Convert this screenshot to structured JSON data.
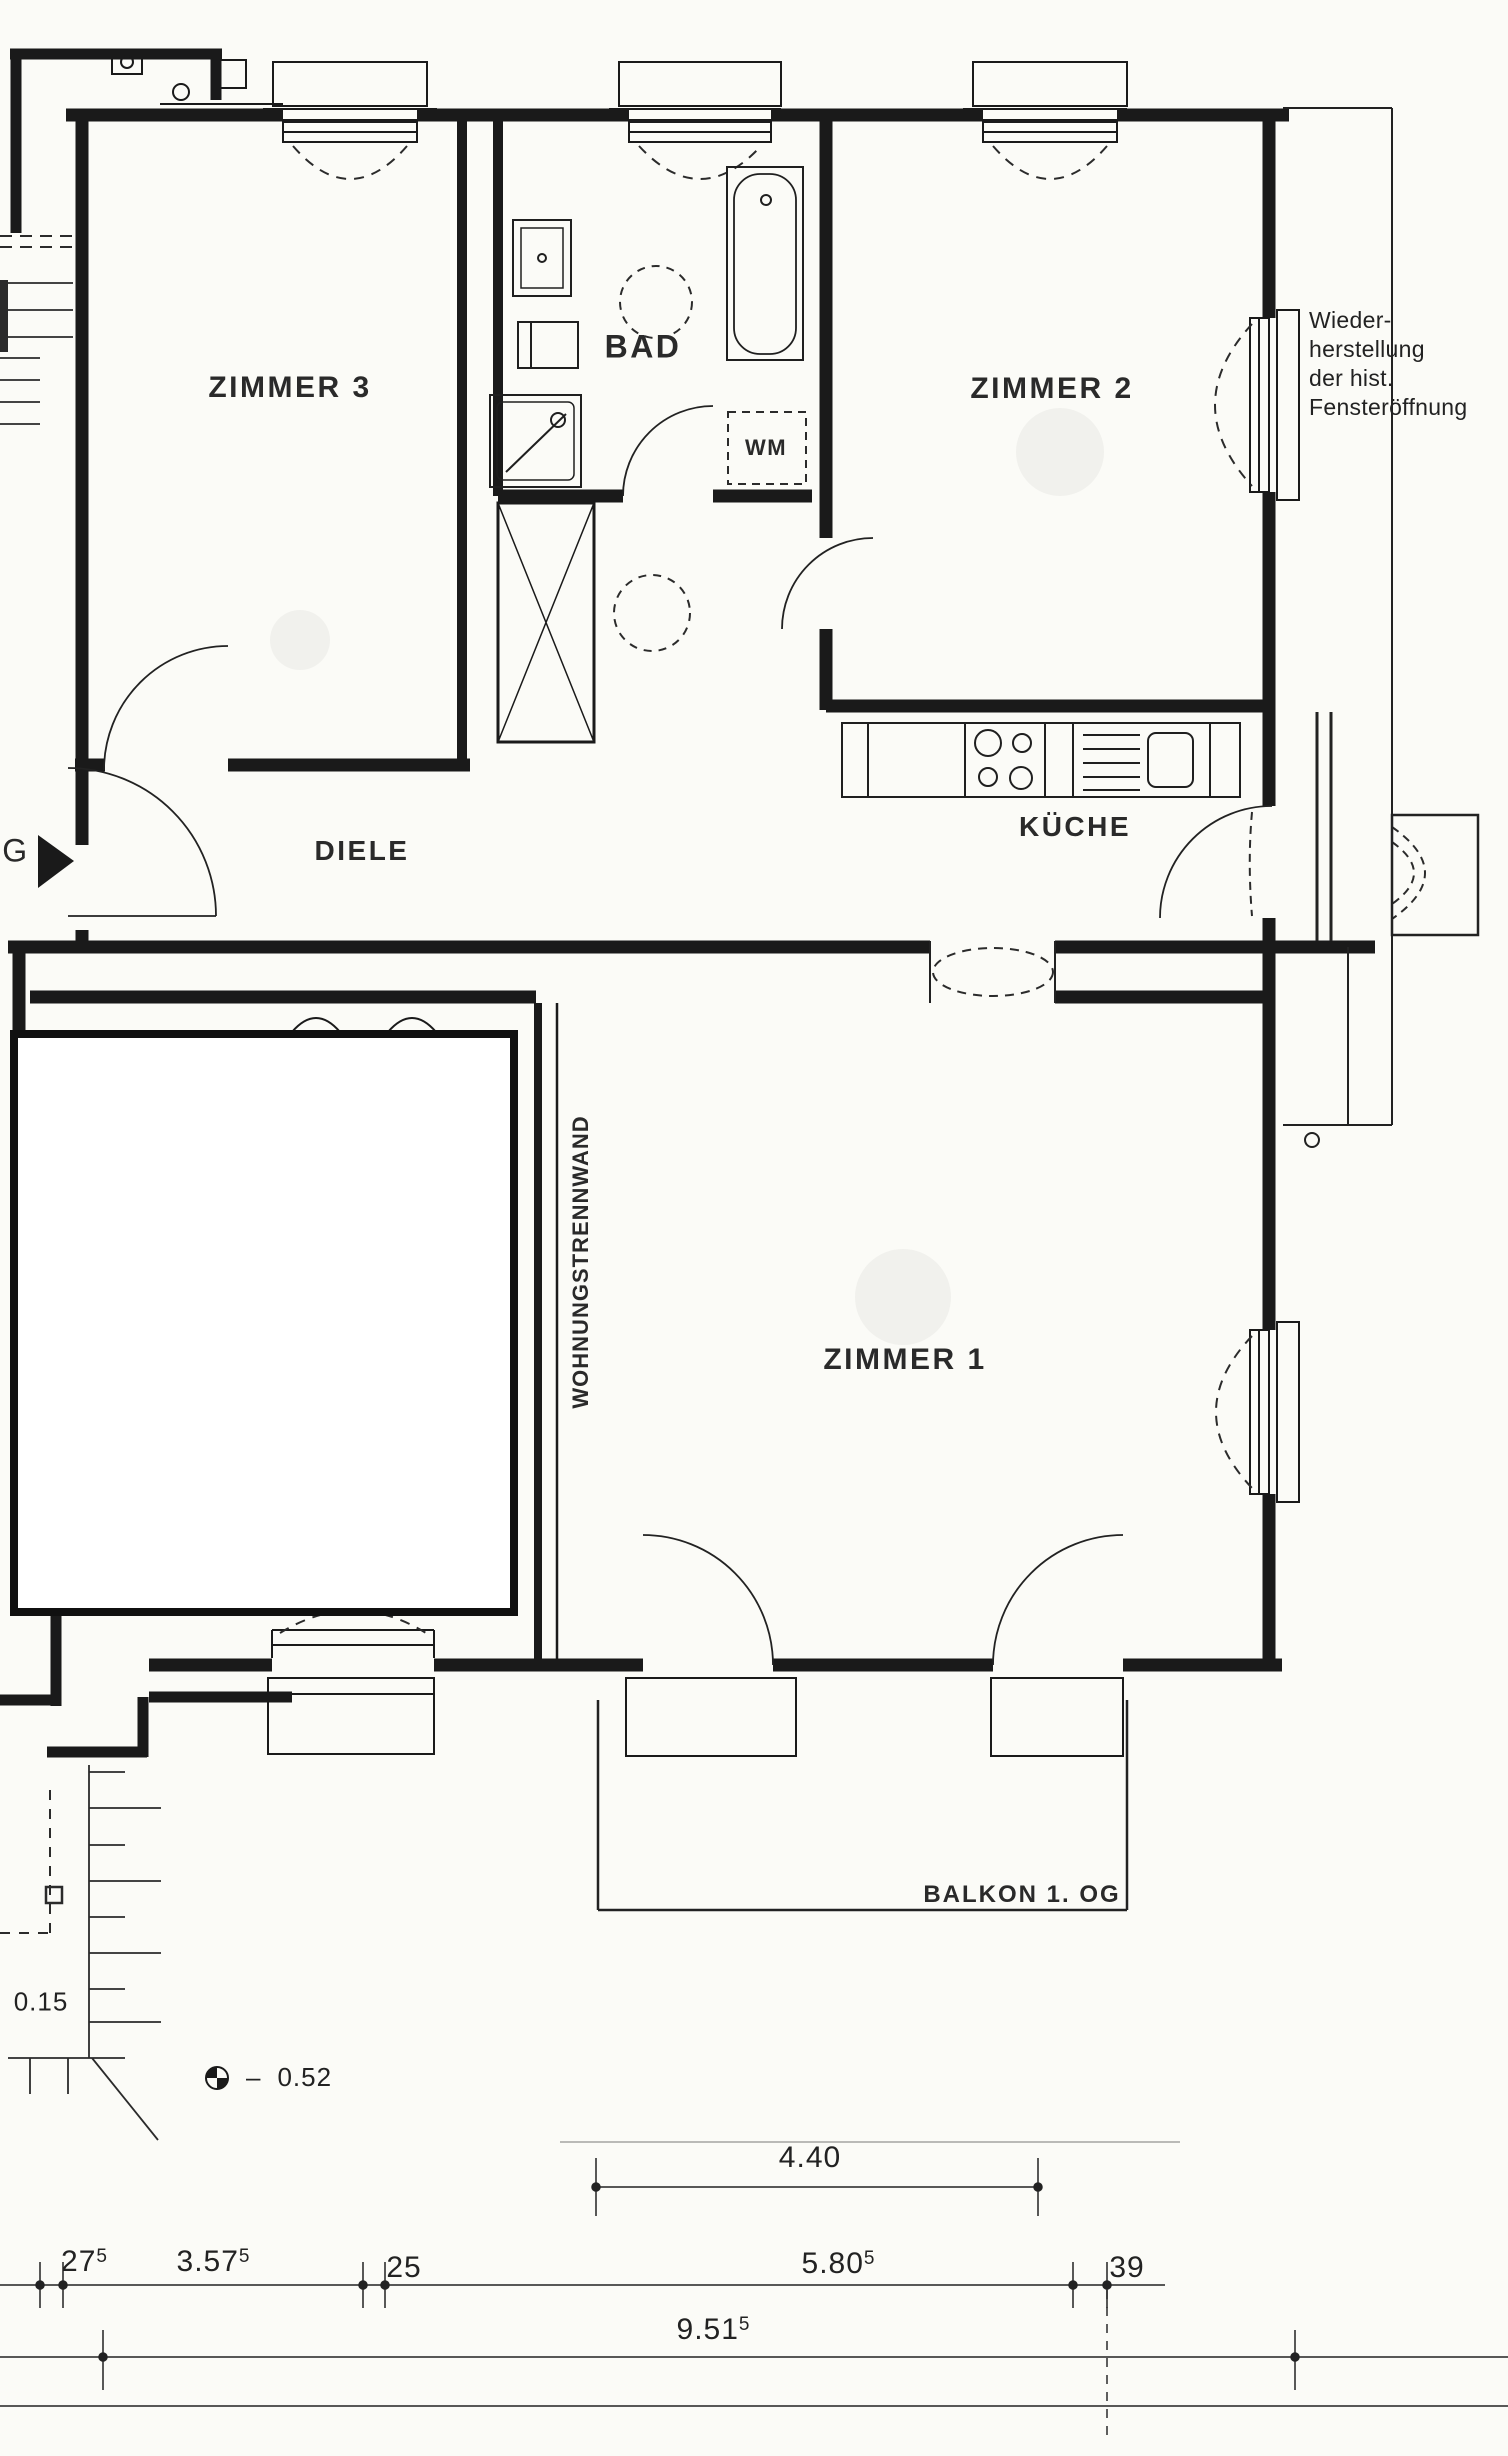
{
  "drawing": {
    "background": "#fbfbf7",
    "ink": "#1f1f1f",
    "type": "apartment floor plan (scanned architectural drawing)"
  },
  "room_labels": {
    "zimmer3": "ZIMMER 3",
    "bad": "BAD",
    "zimmer2": "ZIMMER 2",
    "diele": "DIELE",
    "kueche": "KÜCHE",
    "zimmer1": "ZIMMER 1",
    "wm": "WM",
    "balkon": "BALKON 1. OG",
    "trennwand": "WOHNUNGSTRENNWAND"
  },
  "entrance": {
    "letter": "G"
  },
  "annotation_hist_window": {
    "lines": [
      "Wieder-",
      "herstellung",
      "der hist.",
      "Fensteröffnung"
    ]
  },
  "levels": {
    "floor_offset": "0.15",
    "bench_dash": "–",
    "bench_value": "0.52"
  },
  "dimensions": {
    "balcony_width": "4.40",
    "row": [
      {
        "main": "27",
        "sup": "5"
      },
      {
        "main": "3.57",
        "sup": "5"
      },
      {
        "main": "25",
        "sup": ""
      },
      {
        "main": "5.80",
        "sup": "5"
      },
      {
        "main": "39",
        "sup": ""
      }
    ],
    "total": {
      "main": "9.51",
      "sup": "5"
    }
  },
  "icons": {
    "entrance_arrow": "filled right-pointing triangle",
    "benchmark": "circle with opposite quadrants filled"
  }
}
